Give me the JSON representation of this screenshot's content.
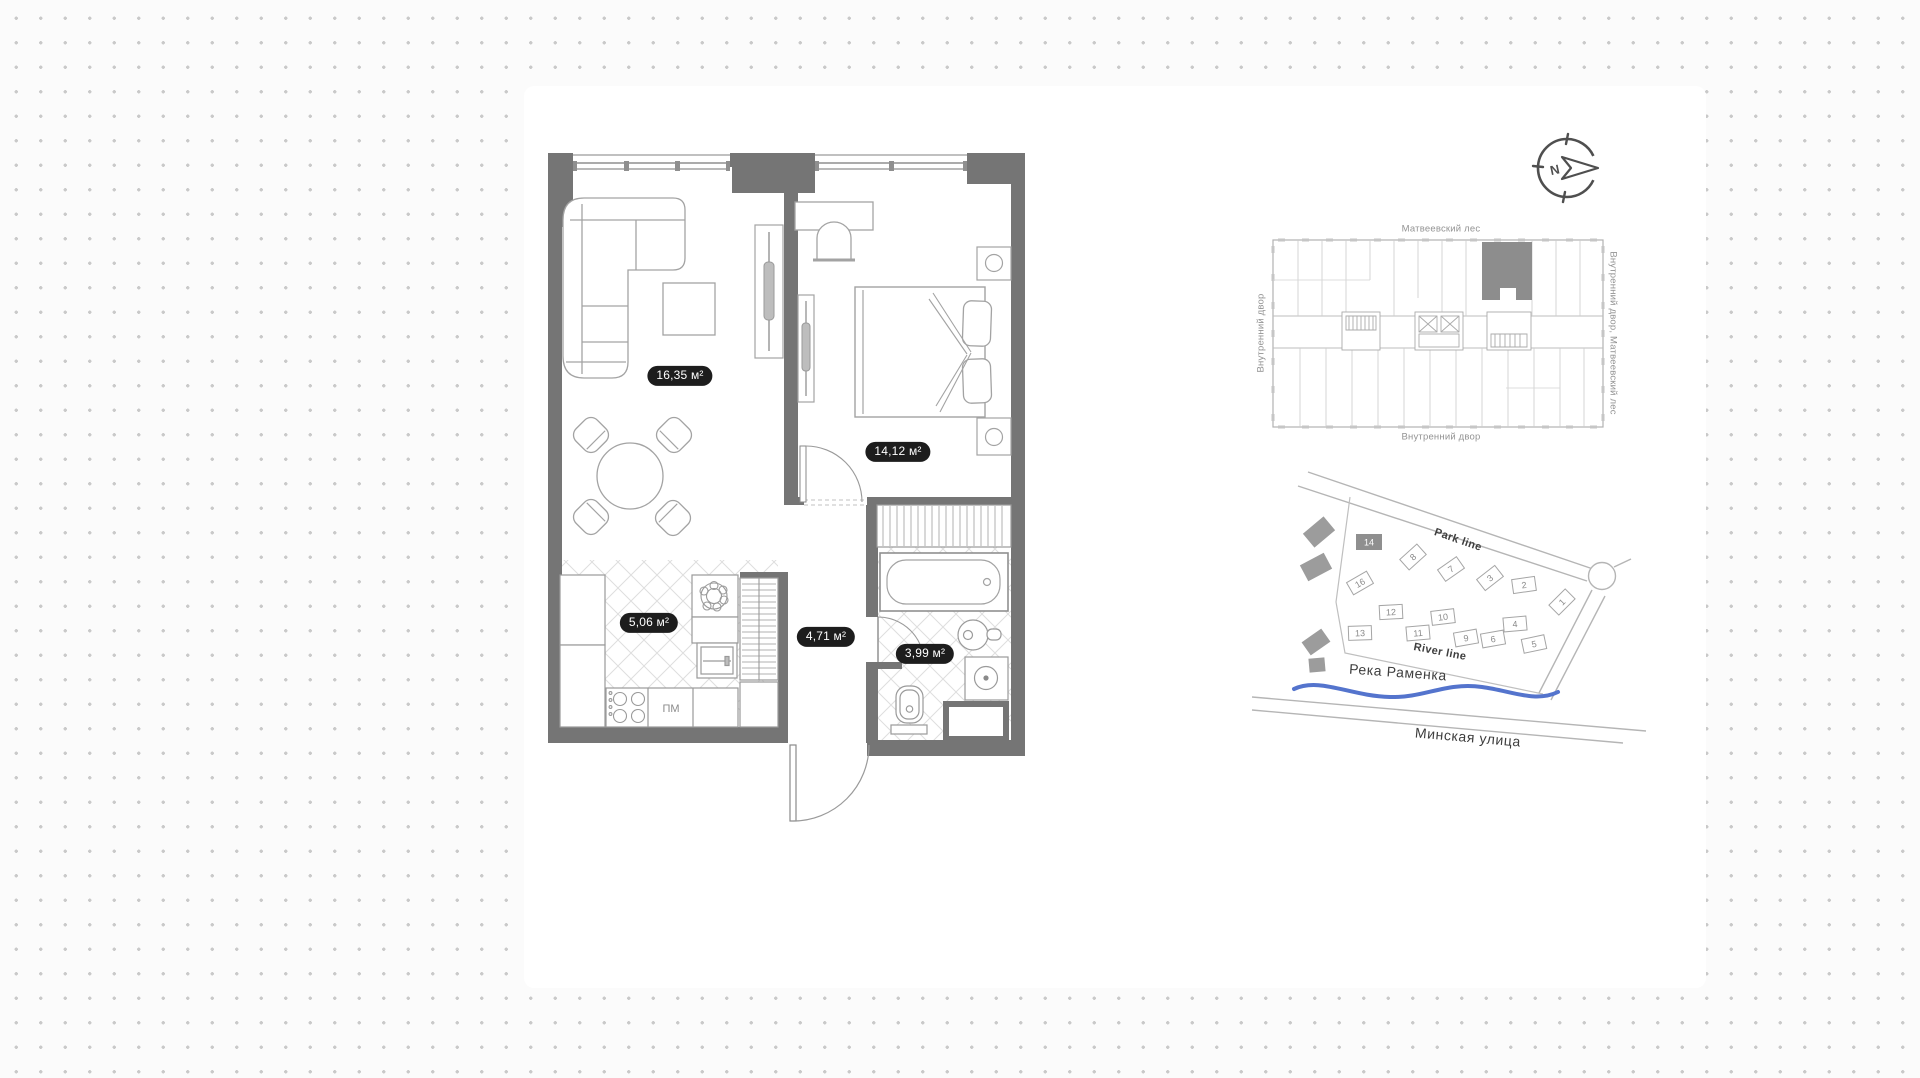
{
  "floor_plan": {
    "rooms": [
      {
        "name": "Living room",
        "area": "16,35 м²"
      },
      {
        "name": "Bedroom",
        "area": "14,12 м²"
      },
      {
        "name": "Kitchen",
        "area": "5,06 м²"
      },
      {
        "name": "Hallway",
        "area": "4,71 м²"
      },
      {
        "name": "Bathroom",
        "area": "3,99 м²"
      }
    ],
    "labels": {
      "dishwasher": "ПМ"
    }
  },
  "compass": {
    "north": "N"
  },
  "building_plan": {
    "label_top": "Матвеевский лес",
    "label_bottom": "Внутренний двор",
    "label_left": "Внутренний двор",
    "label_right": "Внутренний двор, Матвеевский лес"
  },
  "site_map": {
    "labels": {
      "park_line": "Park line",
      "river_line": "River line",
      "river_name": "Река Раменка",
      "street_name": "Минская улица"
    },
    "buildings": [
      {
        "num": "14",
        "current": true
      },
      {
        "num": "8"
      },
      {
        "num": "7"
      },
      {
        "num": "3"
      },
      {
        "num": "2"
      },
      {
        "num": "1"
      },
      {
        "num": "16"
      },
      {
        "num": "12"
      },
      {
        "num": "10"
      },
      {
        "num": "4"
      },
      {
        "num": "13"
      },
      {
        "num": "11"
      },
      {
        "num": "9"
      },
      {
        "num": "6"
      },
      {
        "num": "5"
      }
    ]
  },
  "colors": {
    "wall": "#757575",
    "river": "#5474cd",
    "pill_bg": "#1d1d1d",
    "highlighted_unit": "#8d8d8d",
    "dot_grid": "#c9c9c9"
  }
}
